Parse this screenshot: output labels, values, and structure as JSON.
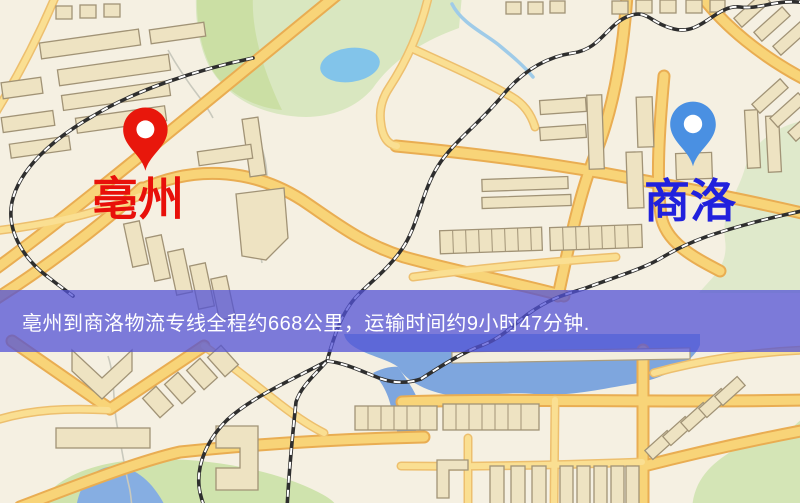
{
  "banner": {
    "text": "亳州到商洛物流专线全程约668公里，运输时间约9小时47分钟.",
    "background_color": "#5353d6",
    "text_color": "#ffffff"
  },
  "route": {
    "origin": "亳州",
    "destination": "商洛",
    "distance_text": "约668公里",
    "duration_text": "约9小时47分钟"
  },
  "markers": {
    "origin": {
      "label": "亳州",
      "pin_color": "#e8170c",
      "label_color": "#e8100a"
    },
    "destination": {
      "label": "商洛",
      "pin_color": "#4a90e2",
      "label_color": "#2121dd"
    }
  }
}
